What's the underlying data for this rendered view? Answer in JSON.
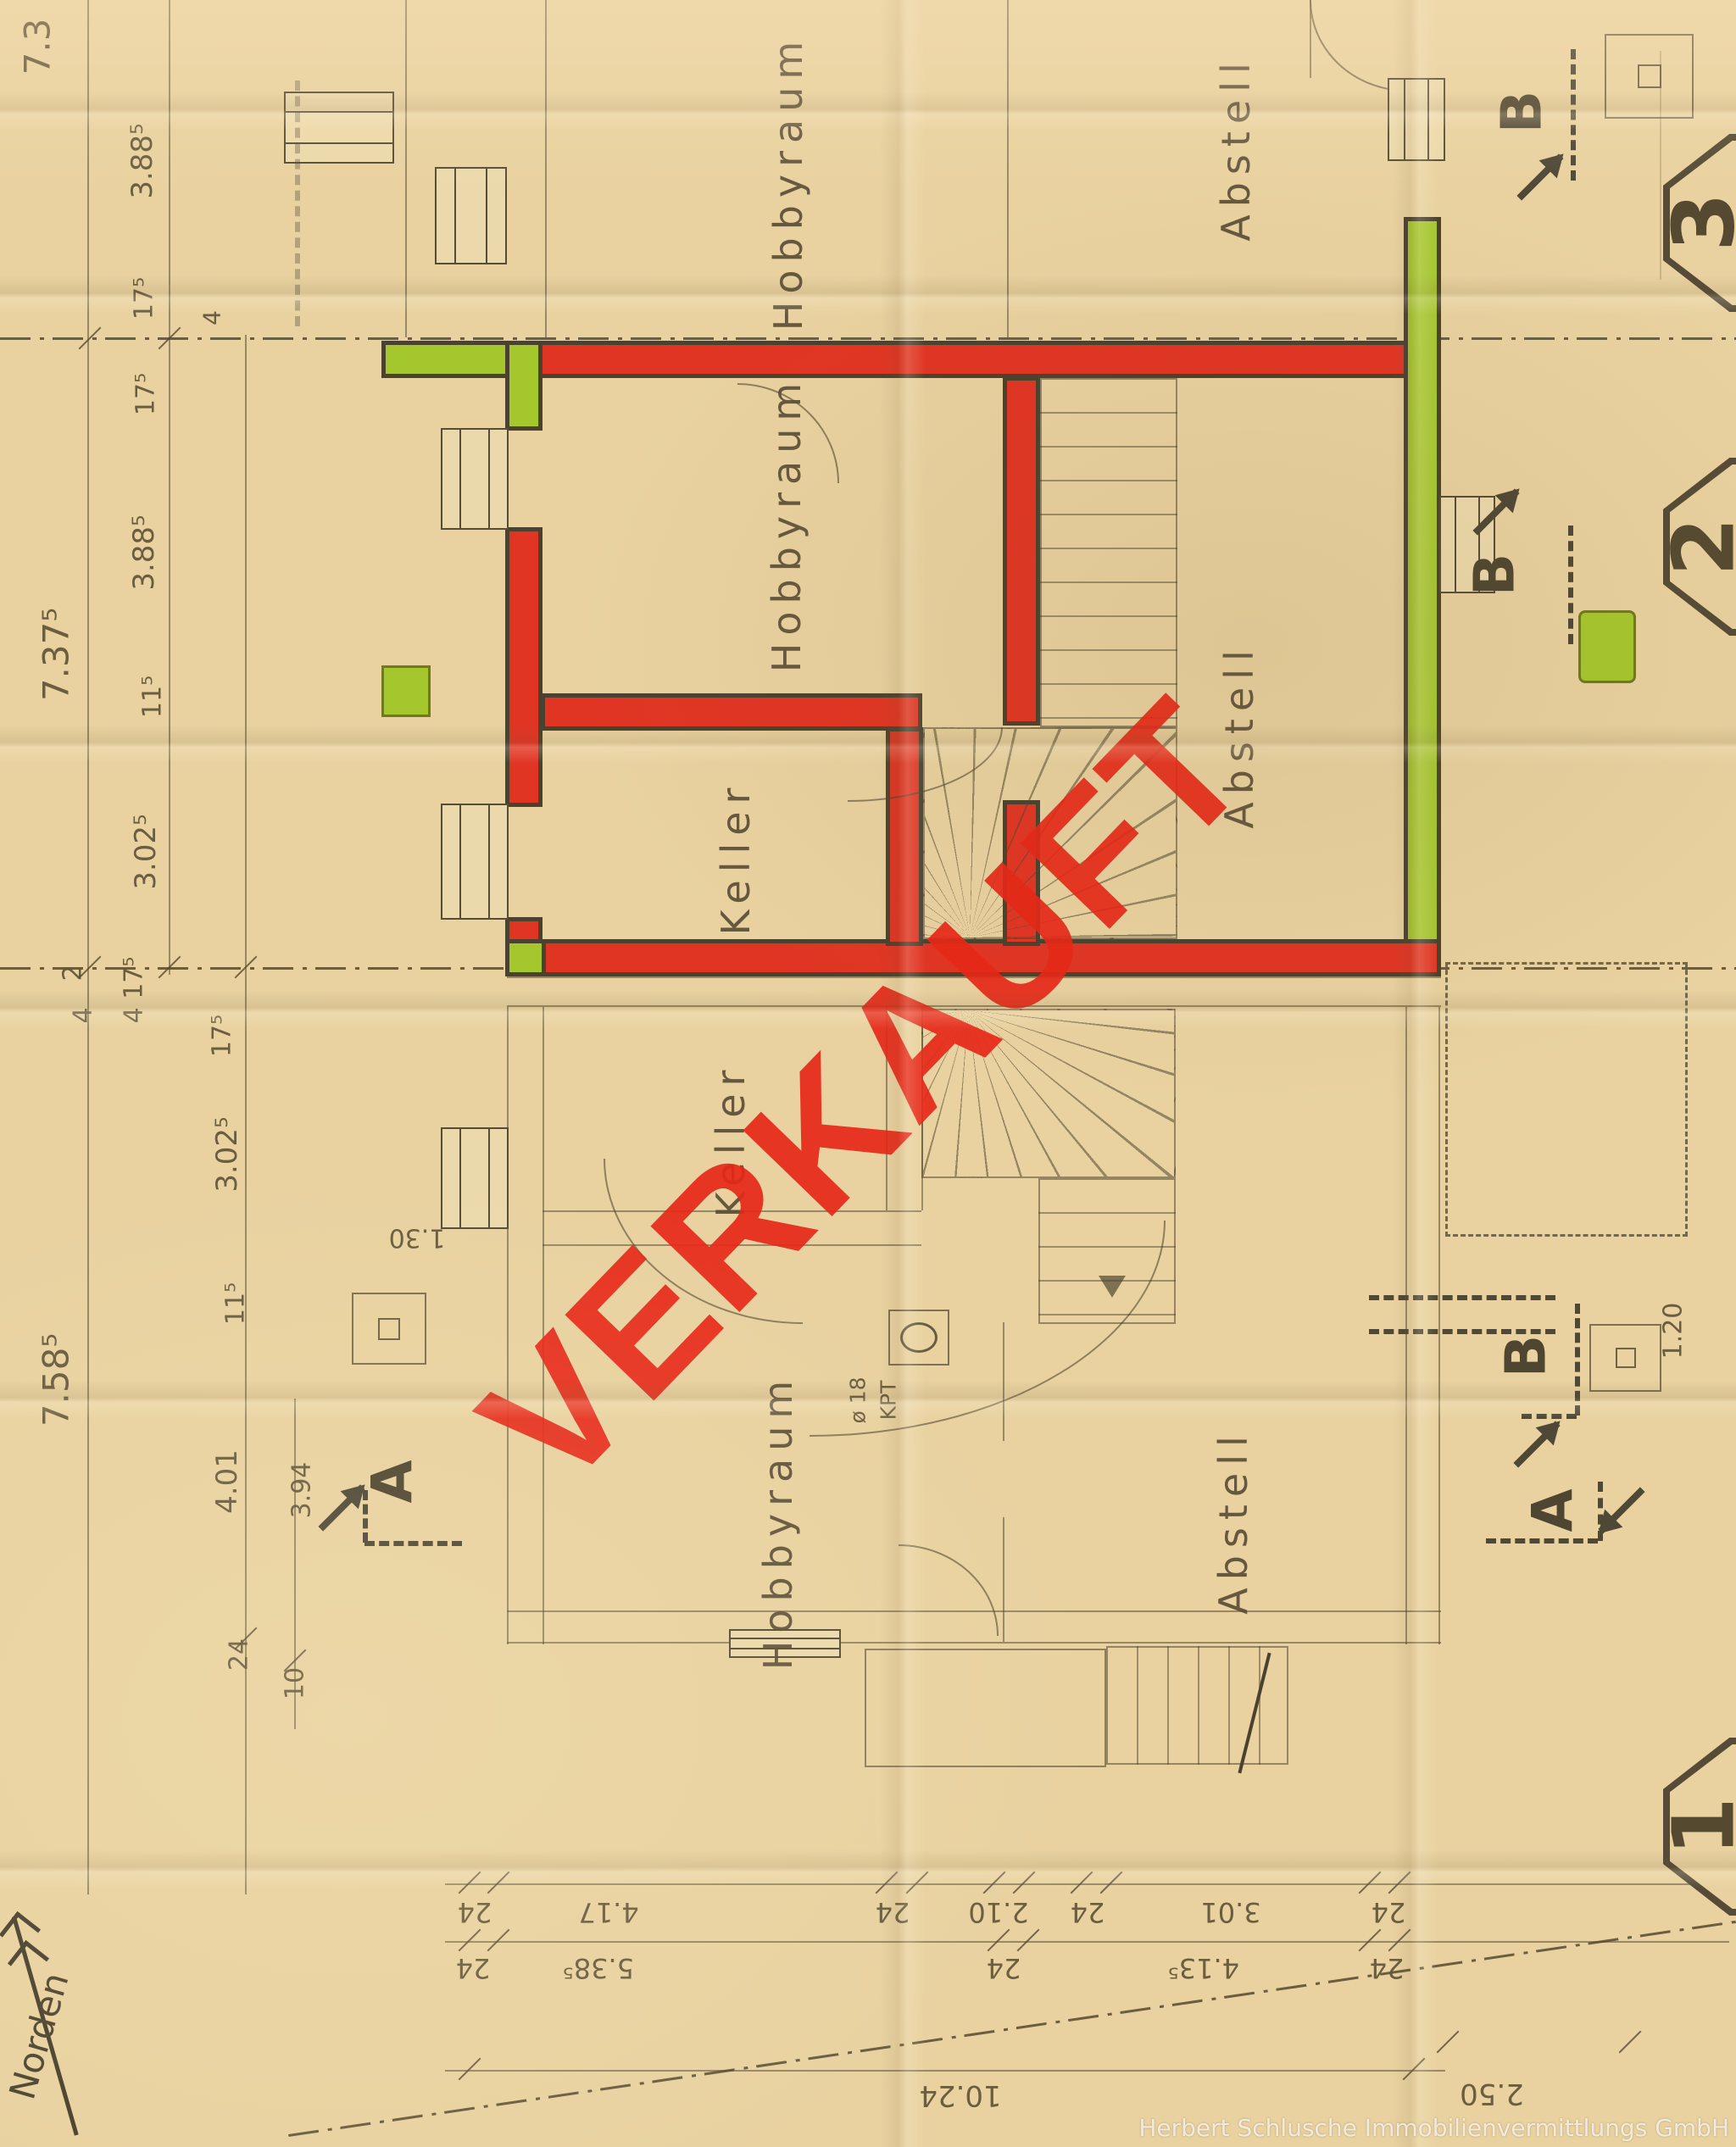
{
  "document": {
    "type": "floor-plan-scan",
    "stamp": {
      "text": "VERKAUFT"
    },
    "watermark": {
      "text": "Herbert Schlusche Immobilienvermittlungs GmbH"
    },
    "north": {
      "label": "Norden"
    }
  },
  "colors": {
    "paper": "#e9d2a0",
    "wall_outline": "#4a422f",
    "sold_wall_red": "#e13524",
    "party_wall_green": "#a5c72e",
    "stamp_red": "#e6271c",
    "ink": "#5f5240"
  },
  "rooms": [
    {
      "id": "upper-hobbyraum",
      "label": "Hobbyraum"
    },
    {
      "id": "upper-abstell",
      "label": "Abstell"
    },
    {
      "id": "mid-hobbyraum",
      "label": "Hobbyraum"
    },
    {
      "id": "mid-abstell",
      "label": "Abstell"
    },
    {
      "id": "mid-keller",
      "label": "Keller"
    },
    {
      "id": "lower-keller",
      "label": "Keller"
    },
    {
      "id": "lower-hobbyraum",
      "label": "Hobbyraum"
    },
    {
      "id": "lower-abstell",
      "label": "Abstell"
    }
  ],
  "markers": {
    "a": "A",
    "b": "B"
  },
  "badges": {
    "top": "3",
    "middle": "2",
    "bottom": "1"
  },
  "dims": {
    "left": [
      {
        "t": "7.3"
      },
      {
        "t": "3.88⁵"
      },
      {
        "t": "17⁵"
      },
      {
        "t": "17⁵"
      },
      {
        "t": "4"
      },
      {
        "t": "3.88⁵"
      },
      {
        "t": "7.37⁵"
      },
      {
        "t": "11⁵"
      },
      {
        "t": "3.02⁵"
      },
      {
        "t": "4 17⁵"
      },
      {
        "t": "17⁵"
      },
      {
        "t": "2"
      },
      {
        "t": "4"
      },
      {
        "t": "3.02⁵"
      },
      {
        "t": "11⁵"
      },
      {
        "t": "7.58⁵"
      },
      {
        "t": "4.01"
      },
      {
        "t": "3.94"
      },
      {
        "t": "24"
      },
      {
        "t": "10"
      }
    ],
    "bottom_row1": [
      "24",
      "4.17",
      "24",
      "2.10",
      "24",
      "3.01",
      "24"
    ],
    "bottom_row2": [
      "24",
      "5.38⁵",
      "24",
      "4.13⁵",
      "24"
    ],
    "totals": [
      "10.24",
      "2.50"
    ],
    "misc": {
      "door": "1.30",
      "right": "1.20",
      "drain_dia": "ø 18",
      "drain_type": "KPT"
    }
  }
}
